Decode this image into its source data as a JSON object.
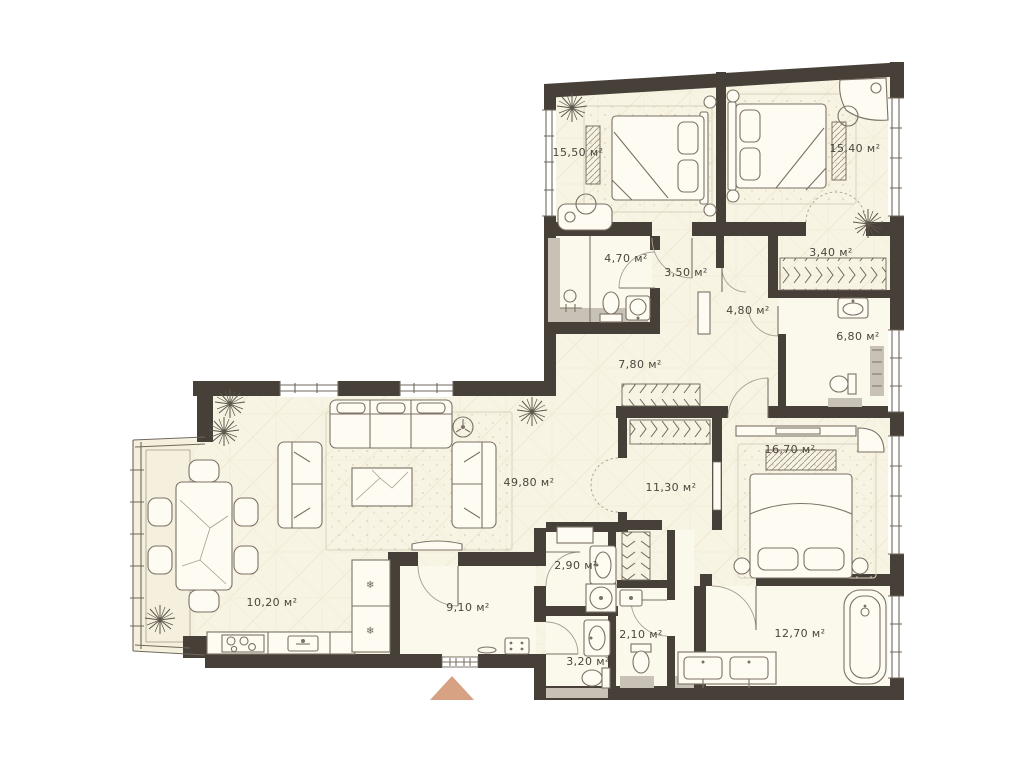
{
  "plan": {
    "type": "apartment-floor-plan",
    "unit": "м²",
    "rooms": [
      {
        "id": "bedroom-1",
        "area": "15,50 м²"
      },
      {
        "id": "bedroom-2",
        "area": "15,40 м²"
      },
      {
        "id": "bathroom-1",
        "area": "4,70 м²"
      },
      {
        "id": "hall-1",
        "area": "3,50 м²"
      },
      {
        "id": "closet",
        "area": "3,40 м²"
      },
      {
        "id": "hall-2",
        "area": "4,80 м²"
      },
      {
        "id": "bathroom-2",
        "area": "6,80 м²"
      },
      {
        "id": "corridor",
        "area": "7,80 м²"
      },
      {
        "id": "living-room",
        "area": "49,80 м²"
      },
      {
        "id": "kitchen-dining",
        "area": "10,20 м²"
      },
      {
        "id": "wardrobe",
        "area": "11,30 м²"
      },
      {
        "id": "bedroom-3",
        "area": "16,70 м²"
      },
      {
        "id": "laundry",
        "area": "2,90 м²"
      },
      {
        "id": "entrance-hall",
        "area": "9,10 м²"
      },
      {
        "id": "wc-1",
        "area": "2,10 м²"
      },
      {
        "id": "wc-2",
        "area": "3,20 м²"
      },
      {
        "id": "bathroom-3",
        "area": "12,70 м²"
      }
    ],
    "freezer_symbol": "❄",
    "colors": {
      "wall": "#474039",
      "floor": "#f8f4e3",
      "wet_floor": "#fbf8ec",
      "threshold_gray": "#c7c2b5",
      "furniture_stroke": "#7b7265",
      "label_text": "#4b453d",
      "entrance_arrow": "#d7a183",
      "background": "#ffffff"
    }
  }
}
